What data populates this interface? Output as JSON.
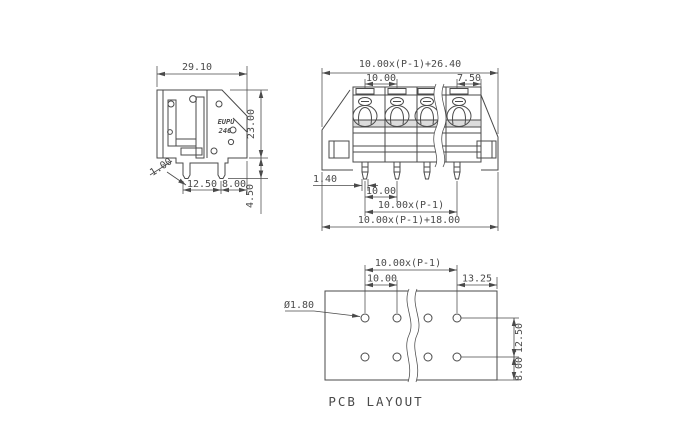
{
  "page": {
    "background": "#ffffff",
    "line_color": "#4a4a4a"
  },
  "side_view": {
    "brand": "EUPU",
    "model": "246",
    "dims": {
      "width": "29.10",
      "height": "23.00",
      "pin_thickness": "1.00",
      "row_spacing": "12.50",
      "edge_margin": "8.00",
      "pin_length": "4.50"
    }
  },
  "front_view": {
    "dims": {
      "overall_top": "10.00x(P-1)+26.40",
      "pitch_top": "10.00",
      "end_margin": "7.50",
      "pin_width": "1.40",
      "pitch_bottom": "10.00",
      "span": "10.00x(P-1)",
      "overall_bottom": "10.00x(P-1)+18.00"
    }
  },
  "pcb_layout": {
    "title": "PCB LAYOUT",
    "dims": {
      "span": "10.00x(P-1)",
      "pitch": "10.00",
      "right_margin": "13.25",
      "hole_diameter": "Ø1.80",
      "row_spacing": "12.50",
      "bottom_margin": "8.00"
    }
  }
}
